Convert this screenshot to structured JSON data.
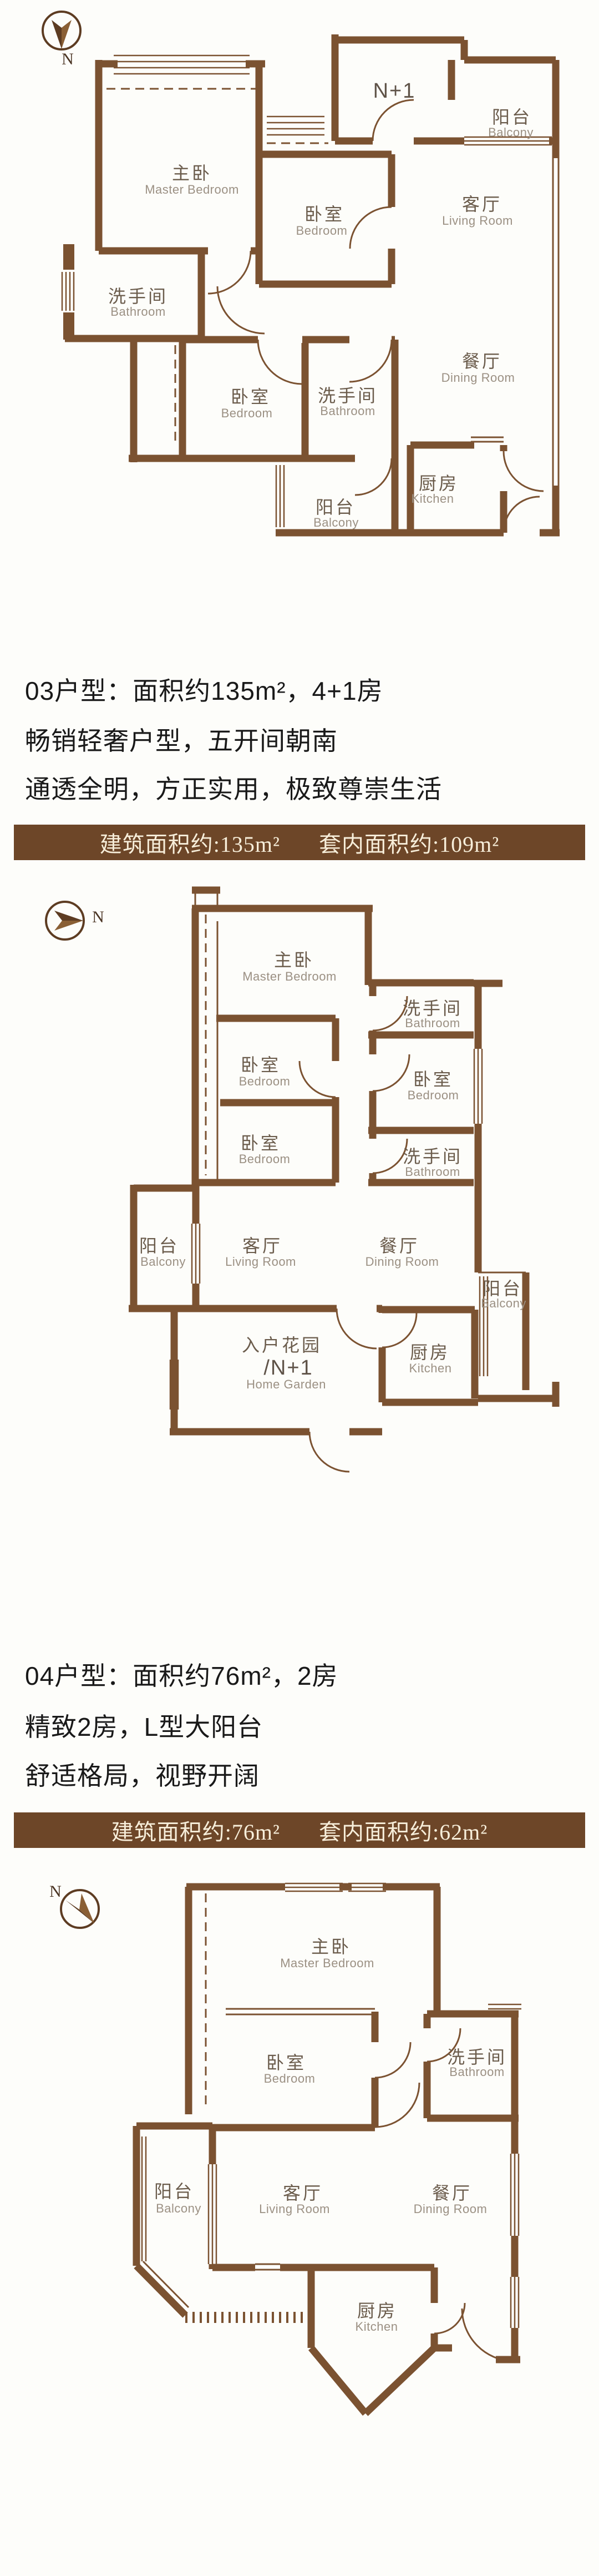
{
  "colors": {
    "wall": "#7b5231",
    "banner_bg": "#6d4628",
    "banner_text": "#f7eeda",
    "heading_text": "#191919",
    "room_zh": "#6b5c4c",
    "room_en": "#9b9083"
  },
  "unit03": {
    "heading_line1": "03户型：面积约135m²，4+1房",
    "heading_line2": "畅销轻奢户型，五开间朝南",
    "heading_line3": "通透全明，方正实用，极致尊崇生活",
    "banner_left": "建筑面积约:135m²",
    "banner_right": "套内面积约:109m²"
  },
  "unit04": {
    "heading_line1": "04户型：面积约76m²，2房",
    "heading_line2": "精致2房，L型大阳台",
    "heading_line3": "舒适格局，视野开阔",
    "banner_left": "建筑面积约:76m²",
    "banner_right": "套内面积约:62m²"
  },
  "plan1": {
    "compass": "N",
    "rooms": {
      "master": {
        "zh": "主卧",
        "en": "Master Bedroom"
      },
      "bedroom_top": {
        "zh": "卧室",
        "en": "Bedroom"
      },
      "nplus1": "N+1",
      "balcony_top": {
        "zh": "阳台",
        "en": "Balcony"
      },
      "living": {
        "zh": "客厅",
        "en": "Living Room"
      },
      "dining": {
        "zh": "餐厅",
        "en": "Dining Room"
      },
      "bathroom_left": {
        "zh": "洗手间",
        "en": "Bathroom"
      },
      "bedroom_mid": {
        "zh": "卧室",
        "en": "Bedroom"
      },
      "bathroom_mid": {
        "zh": "洗手间",
        "en": "Bathroom"
      },
      "balcony_bottom": {
        "zh": "阳台",
        "en": "Balcony"
      },
      "kitchen": {
        "zh": "厨房",
        "en": "Kitchen"
      }
    }
  },
  "plan2": {
    "compass": "N",
    "rooms": {
      "master": {
        "zh": "主卧",
        "en": "Master Bedroom"
      },
      "bathroom_top": {
        "zh": "洗手间",
        "en": "Bathroom"
      },
      "bedroom_right": {
        "zh": "卧室",
        "en": "Bedroom"
      },
      "bathroom_mid": {
        "zh": "洗手间",
        "en": "Bathroom"
      },
      "bedroom_a": {
        "zh": "卧室",
        "en": "Bedroom"
      },
      "bedroom_b": {
        "zh": "卧室",
        "en": "Bedroom"
      },
      "living": {
        "zh": "客厅",
        "en": "Living Room"
      },
      "dining": {
        "zh": "餐厅",
        "en": "Dining Room"
      },
      "balcony_left": {
        "zh": "阳台",
        "en": "Balcony"
      },
      "balcony_right": {
        "zh": "阳台",
        "en": "Balcony"
      },
      "garden": {
        "zh": "入户花园",
        "tag": "/N+1",
        "en": "Home Garden"
      },
      "kitchen": {
        "zh": "厨房",
        "en": "Kitchen"
      }
    }
  },
  "plan3": {
    "compass": "N",
    "rooms": {
      "master": {
        "zh": "主卧",
        "en": "Master Bedroom"
      },
      "bedroom": {
        "zh": "卧室",
        "en": "Bedroom"
      },
      "bathroom": {
        "zh": "洗手间",
        "en": "Bathroom"
      },
      "balcony": {
        "zh": "阳台",
        "en": "Balcony"
      },
      "living": {
        "zh": "客厅",
        "en": "Living Room"
      },
      "dining": {
        "zh": "餐厅",
        "en": "Dining Room"
      },
      "kitchen": {
        "zh": "厨房",
        "en": "Kitchen"
      }
    }
  }
}
